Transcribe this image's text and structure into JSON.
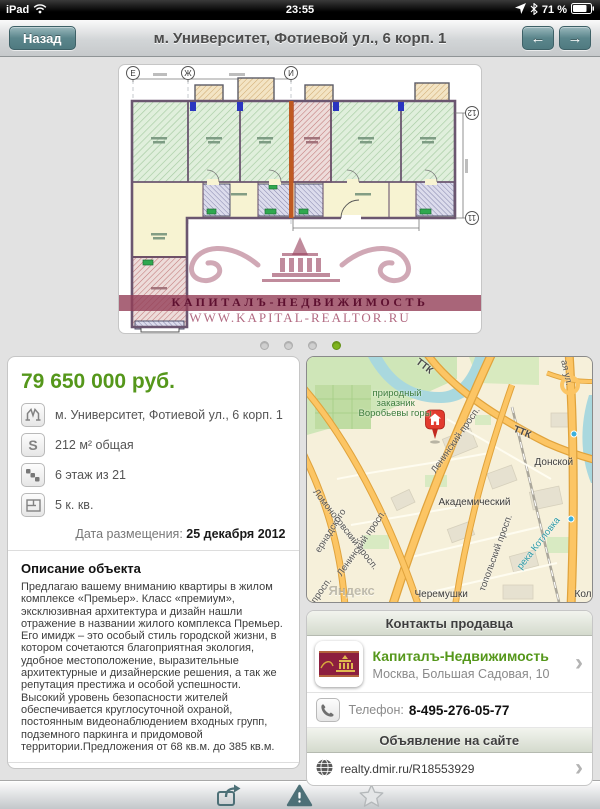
{
  "colors": {
    "accent_green": "#55971b",
    "teal_button": "#5b868c",
    "watermark_maroon": "#8c2a4e",
    "pin_red": "#e23b2e"
  },
  "status_bar": {
    "carrier": "iPad",
    "time": "23:55",
    "battery": "71 %"
  },
  "nav_bar": {
    "back_label": "Назад",
    "title": "м. Университет, Фотиевой ул., 6 корп. 1",
    "left_arrow": "←",
    "right_arrow": "→"
  },
  "photo": {
    "watermark_line1": "КАПИТАЛЪ-НЕДВИЖИМОСТЬ",
    "watermark_line2": "WWW.KAPITAL-REALTOR.RU",
    "grid_labels": {
      "e": "Е",
      "zh": "Ж",
      "i": "И",
      "n12": "12",
      "n11": "11"
    }
  },
  "listing": {
    "price": "79 650 000 руб.",
    "attributes": [
      {
        "icon": "metro-icon",
        "text": "м. Университет, Фотиевой ул., 6 корп. 1"
      },
      {
        "icon": "area-icon",
        "text": "212 м² общая"
      },
      {
        "icon": "floor-icon",
        "text": "6 этаж из 21"
      },
      {
        "icon": "rooms-icon",
        "text": "5 к. кв."
      }
    ],
    "area_icon_letter": "S",
    "date_label": "Дата размещения: ",
    "date_value": "25 декабря 2012",
    "description_title": "Описание объекта",
    "description": "Предлагаю вашему вниманию квартиры в жилом комплексе «Премьер». Класс «премиум», эксклюзивная архитектура и дизайн нашли отражение в названии жилого комплекса Премьер. Его имидж – это особый стиль городской жизни, в котором сочетаются благоприятная экология, удобное местоположение, выразительные архитектурные и дизайнерские решения, а так же репутация престижа и особой успешности. Высокий уровень безопасности жителей обеспечивается круглосуточной охраной, постоянным видеонаблюдением входных групп, подземного паркинга и придомовой территории.Предложения от 68 кв.м. до 385 кв.м.",
    "basics_title": "Основные",
    "basics_rows": [
      {
        "label": "Площадь",
        "value": "212 м²"
      }
    ]
  },
  "map": {
    "labels": {
      "ttk1": "ТТК",
      "ttk2": "ТТК",
      "park1": "природный",
      "park2": "заказник",
      "park3": "Воробьевы горы",
      "lomonosovsky": "Ломоносовский просп.",
      "leninsky1": "Ленинский просп.",
      "leninsky2": "Ленинский просп.",
      "sevastopolsky": "топольский просп.",
      "academichesky": "Академический",
      "donskoy": "Донской",
      "cheremushki": "Черемушки",
      "river": "река Котловка",
      "vernadskogo": "ернадского",
      "prosp": "просп.",
      "street_tr": "ая ул.",
      "kol": "Кол",
      "yandex": "Яндекс"
    }
  },
  "contacts": {
    "header": "Контакты продавца",
    "agency_name": "Капиталъ-Недвижимость",
    "agency_address": "Москва, Большая Садовая, 10",
    "phone_label": "Телефон:",
    "phone_value": "8-495-276-05-77",
    "site_header": "Объявление на сайте",
    "site_url": "realty.dmir.ru/R18553929"
  },
  "ui": {
    "chevron": "›"
  },
  "toolbar": {
    "icons": [
      "share-icon",
      "report-icon",
      "favorite-icon"
    ]
  }
}
